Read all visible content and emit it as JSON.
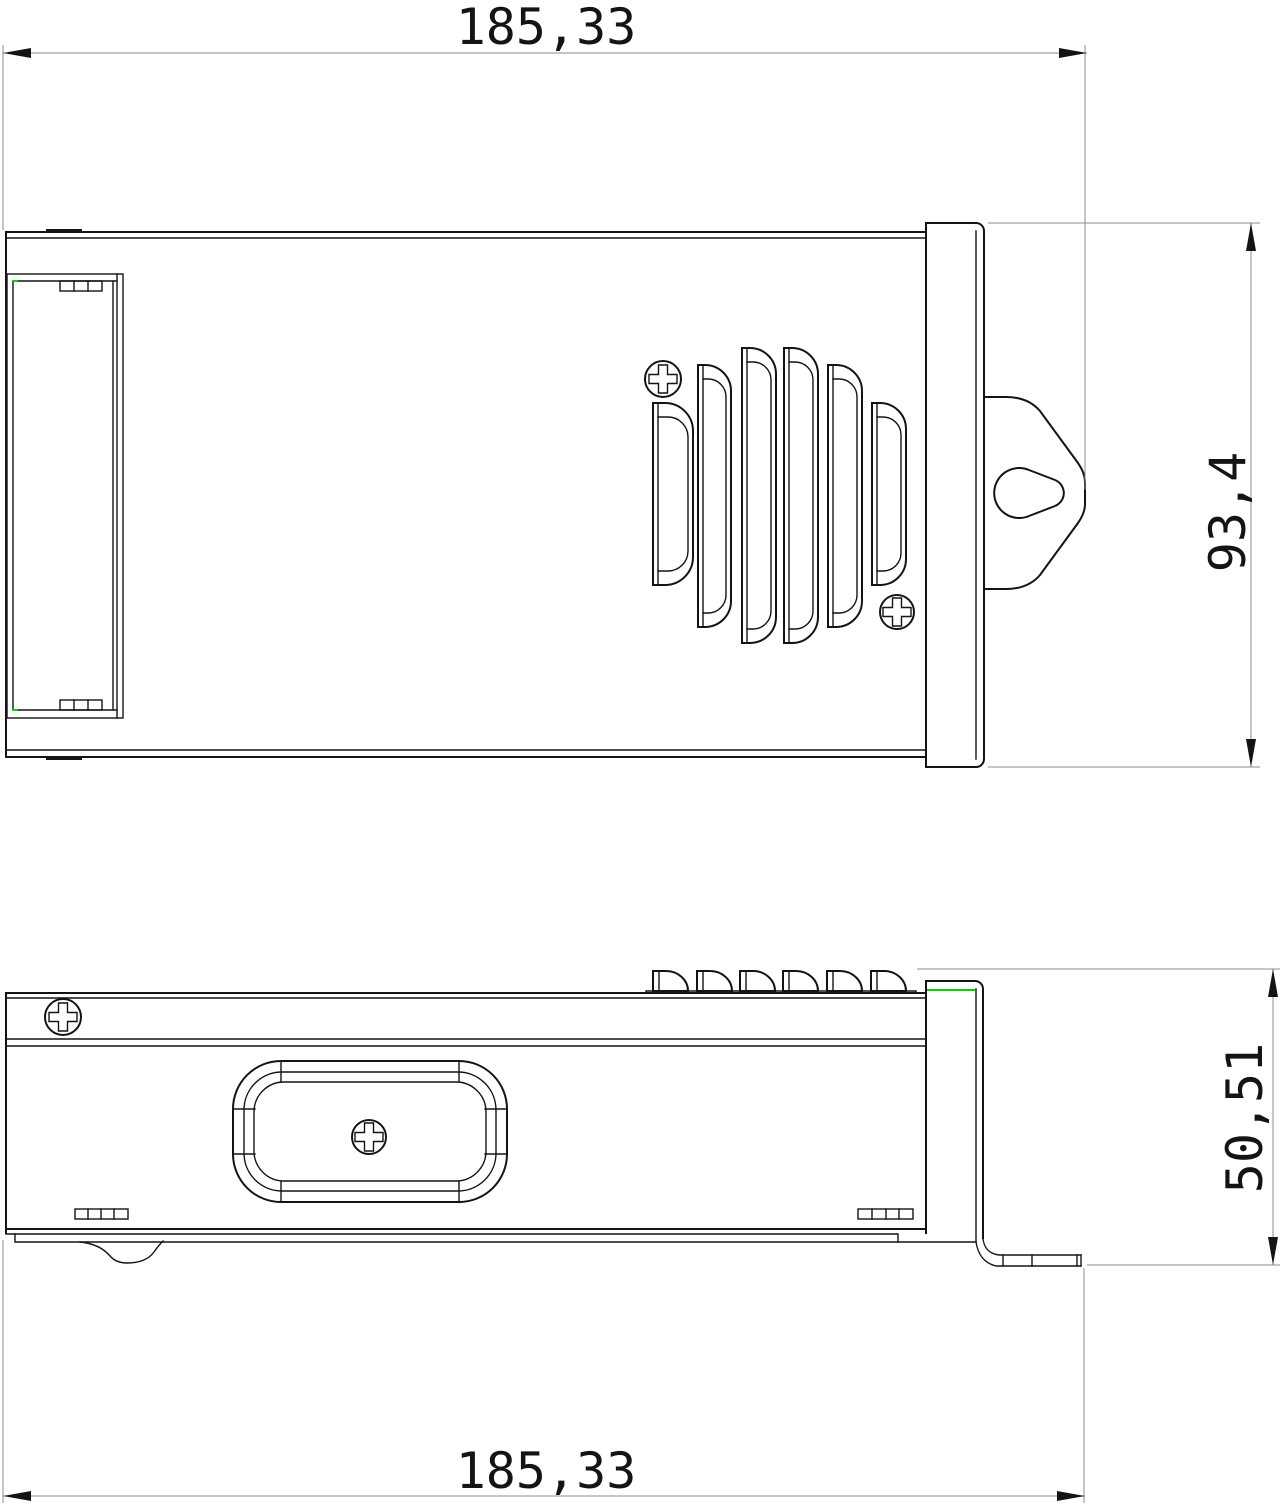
{
  "drawing": {
    "dimensions": {
      "top_width": "185,33",
      "right_height": "93,4",
      "side_height": "50,51",
      "bottom_width": "185,33"
    },
    "colors": {
      "outline": "#141414",
      "dimension_lines": "#8c8c8c",
      "highlight_green": "#00d400",
      "background": "#ffffff"
    }
  }
}
